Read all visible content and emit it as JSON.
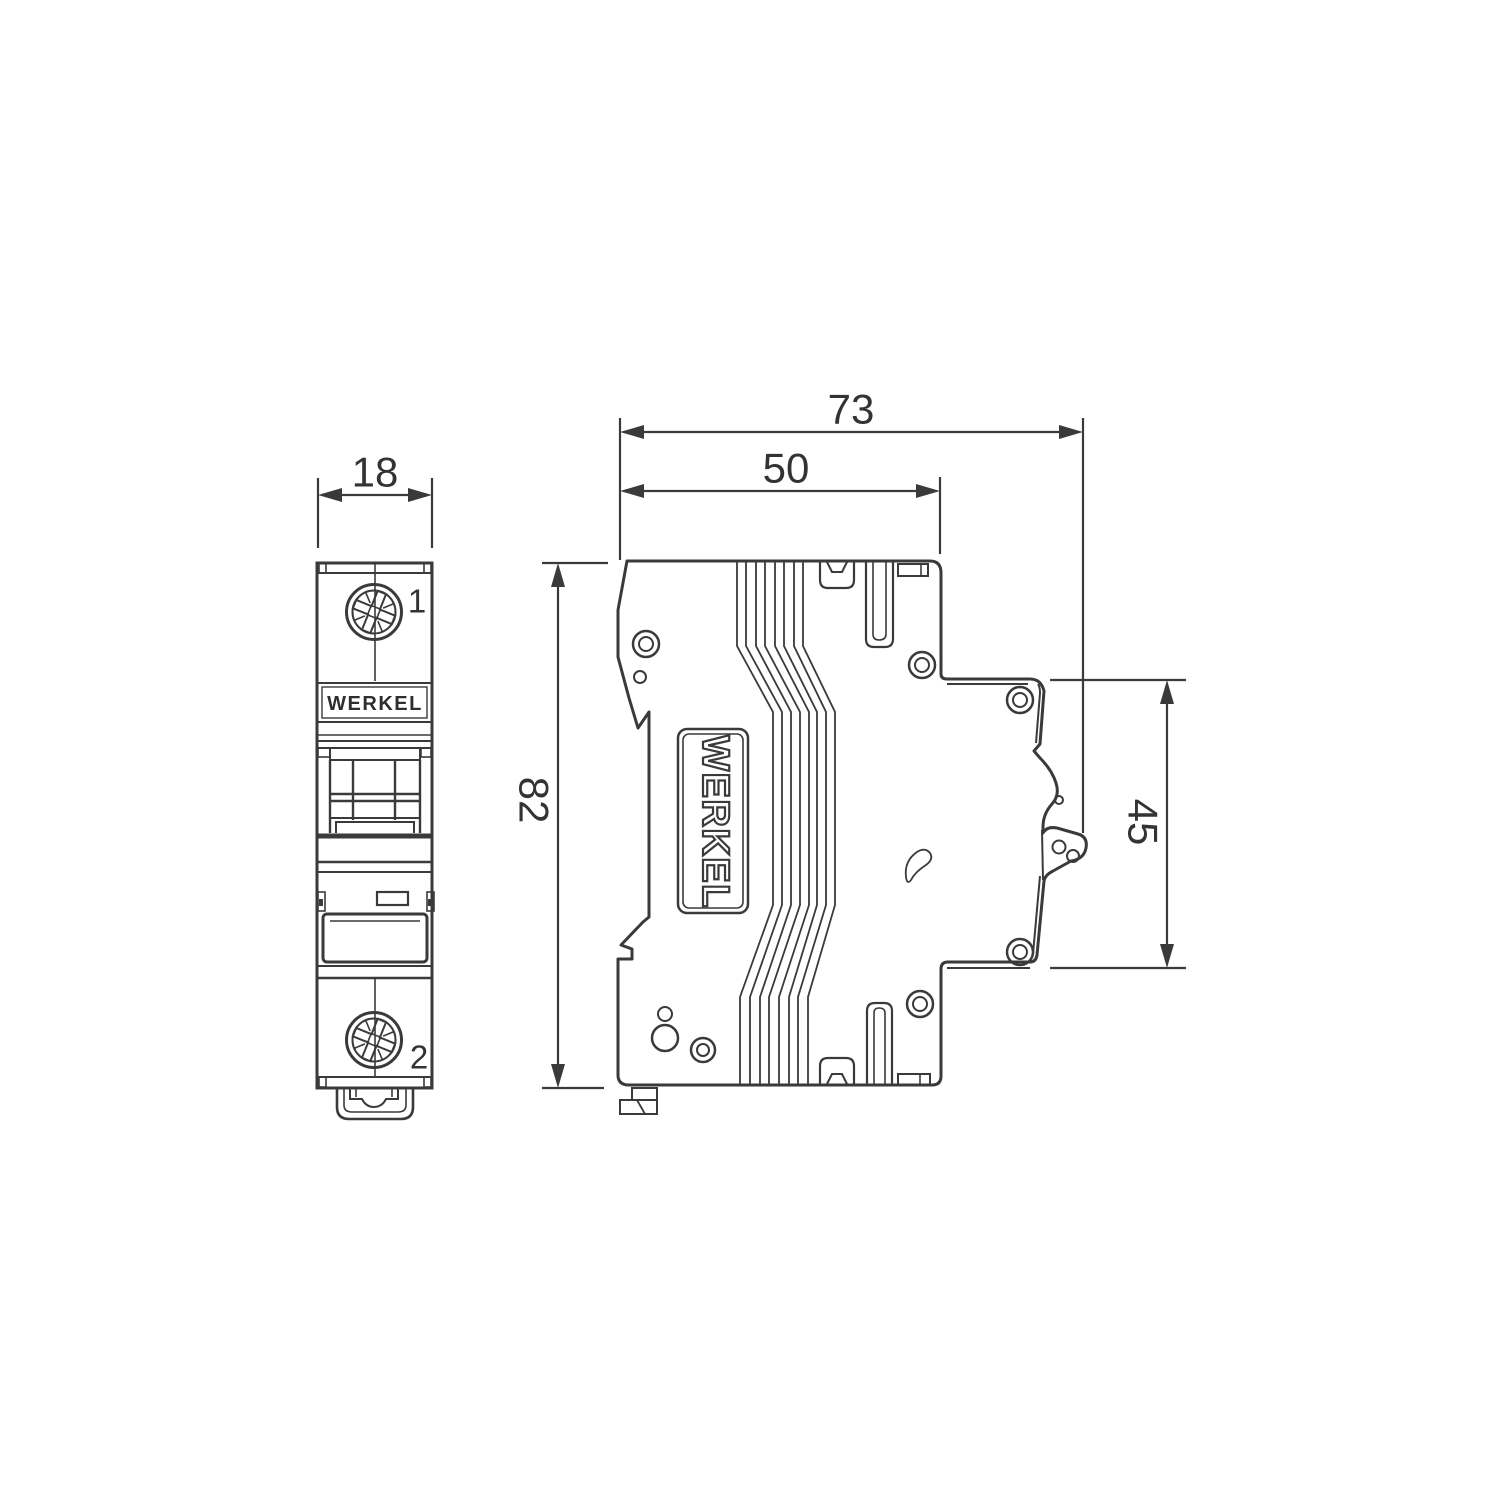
{
  "drawing": {
    "background": "#ffffff",
    "line_color": "#3a3a3a",
    "text_color": "#333333",
    "front_view": {
      "width_dim": "18",
      "terminal_top_label": "1",
      "terminal_bottom_label": "2",
      "brand": "WERKEL"
    },
    "side_view": {
      "overall_depth_dim": "73",
      "body_depth_dim": "50",
      "height_dim": "82",
      "inner_height_dim": "45",
      "brand": "WERKEL"
    }
  }
}
